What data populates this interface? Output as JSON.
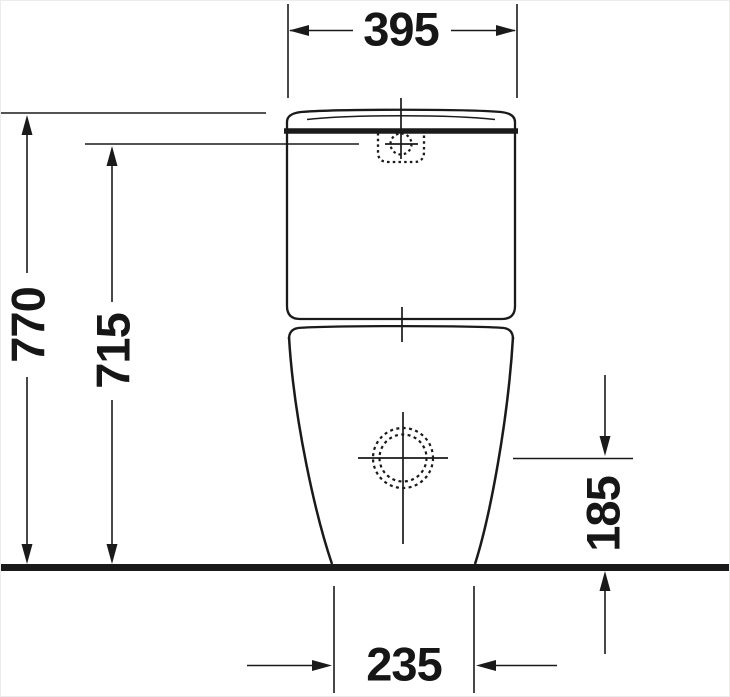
{
  "drawing": {
    "kind": "technical dimension drawing, front elevation of a close-coupled floorstanding toilet",
    "colors": {
      "line": "#1a1a1a",
      "background": "#ffffff"
    },
    "dimensions": {
      "width_top": "395",
      "height_total": "770",
      "height_button": "715",
      "height_outlet": "185",
      "width_base": "235"
    }
  }
}
